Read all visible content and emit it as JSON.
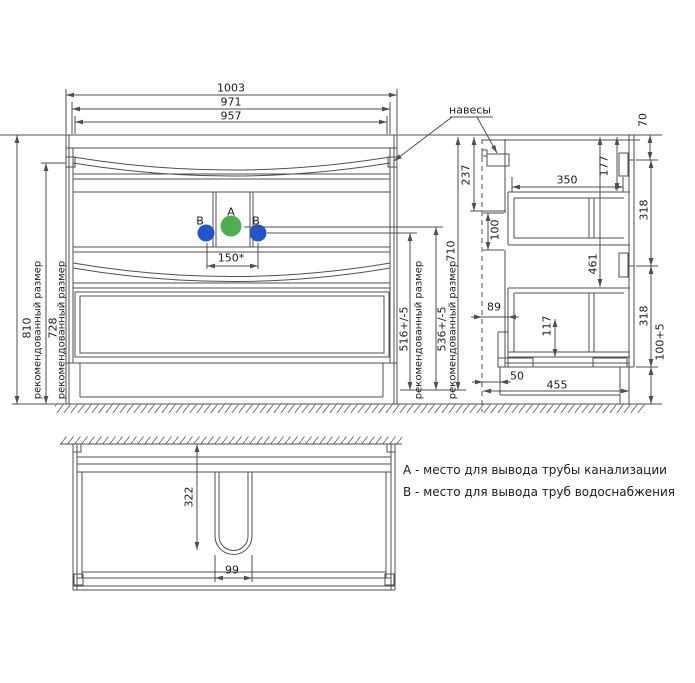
{
  "views": {
    "front": {
      "width_dims": {
        "overall": "1003",
        "mid": "971",
        "inner": "957"
      },
      "height_dims": {
        "overall": "810",
        "hangers": "728",
        "note": "рекомендованный размер"
      },
      "outlet_dims": {
        "b_height": "516+/-5",
        "a_height": "536+/-5",
        "body_height": "710",
        "b_spacing": "150*"
      },
      "points": {
        "a": "A",
        "b_left": "B",
        "b_right": "B"
      },
      "hangers_label": "навесы"
    },
    "side": {
      "dims": {
        "countertop": "70",
        "hanger_drop": "237",
        "drawer_top_inset": "177",
        "drawer_depth": "350",
        "back_opening": "100",
        "drawer_reach": "461",
        "upper_front": "318",
        "lower_front": "318",
        "back_gap": "89",
        "bottom_rail": "117",
        "plinth_height": "100+5",
        "plinth_recess": "50",
        "depth": "455"
      }
    },
    "bottom": {
      "dims": {
        "cutout_depth": "322",
        "cutout_width": "99"
      }
    }
  },
  "legend": {
    "a": "A - место для вывода трубы канализации",
    "b": "B - место для вывода труб водоснабжения"
  },
  "colors": {
    "point_a": "#4caf50",
    "point_b": "#2156cd",
    "line": "#4f4f4f",
    "text": "#1c1c1c"
  }
}
